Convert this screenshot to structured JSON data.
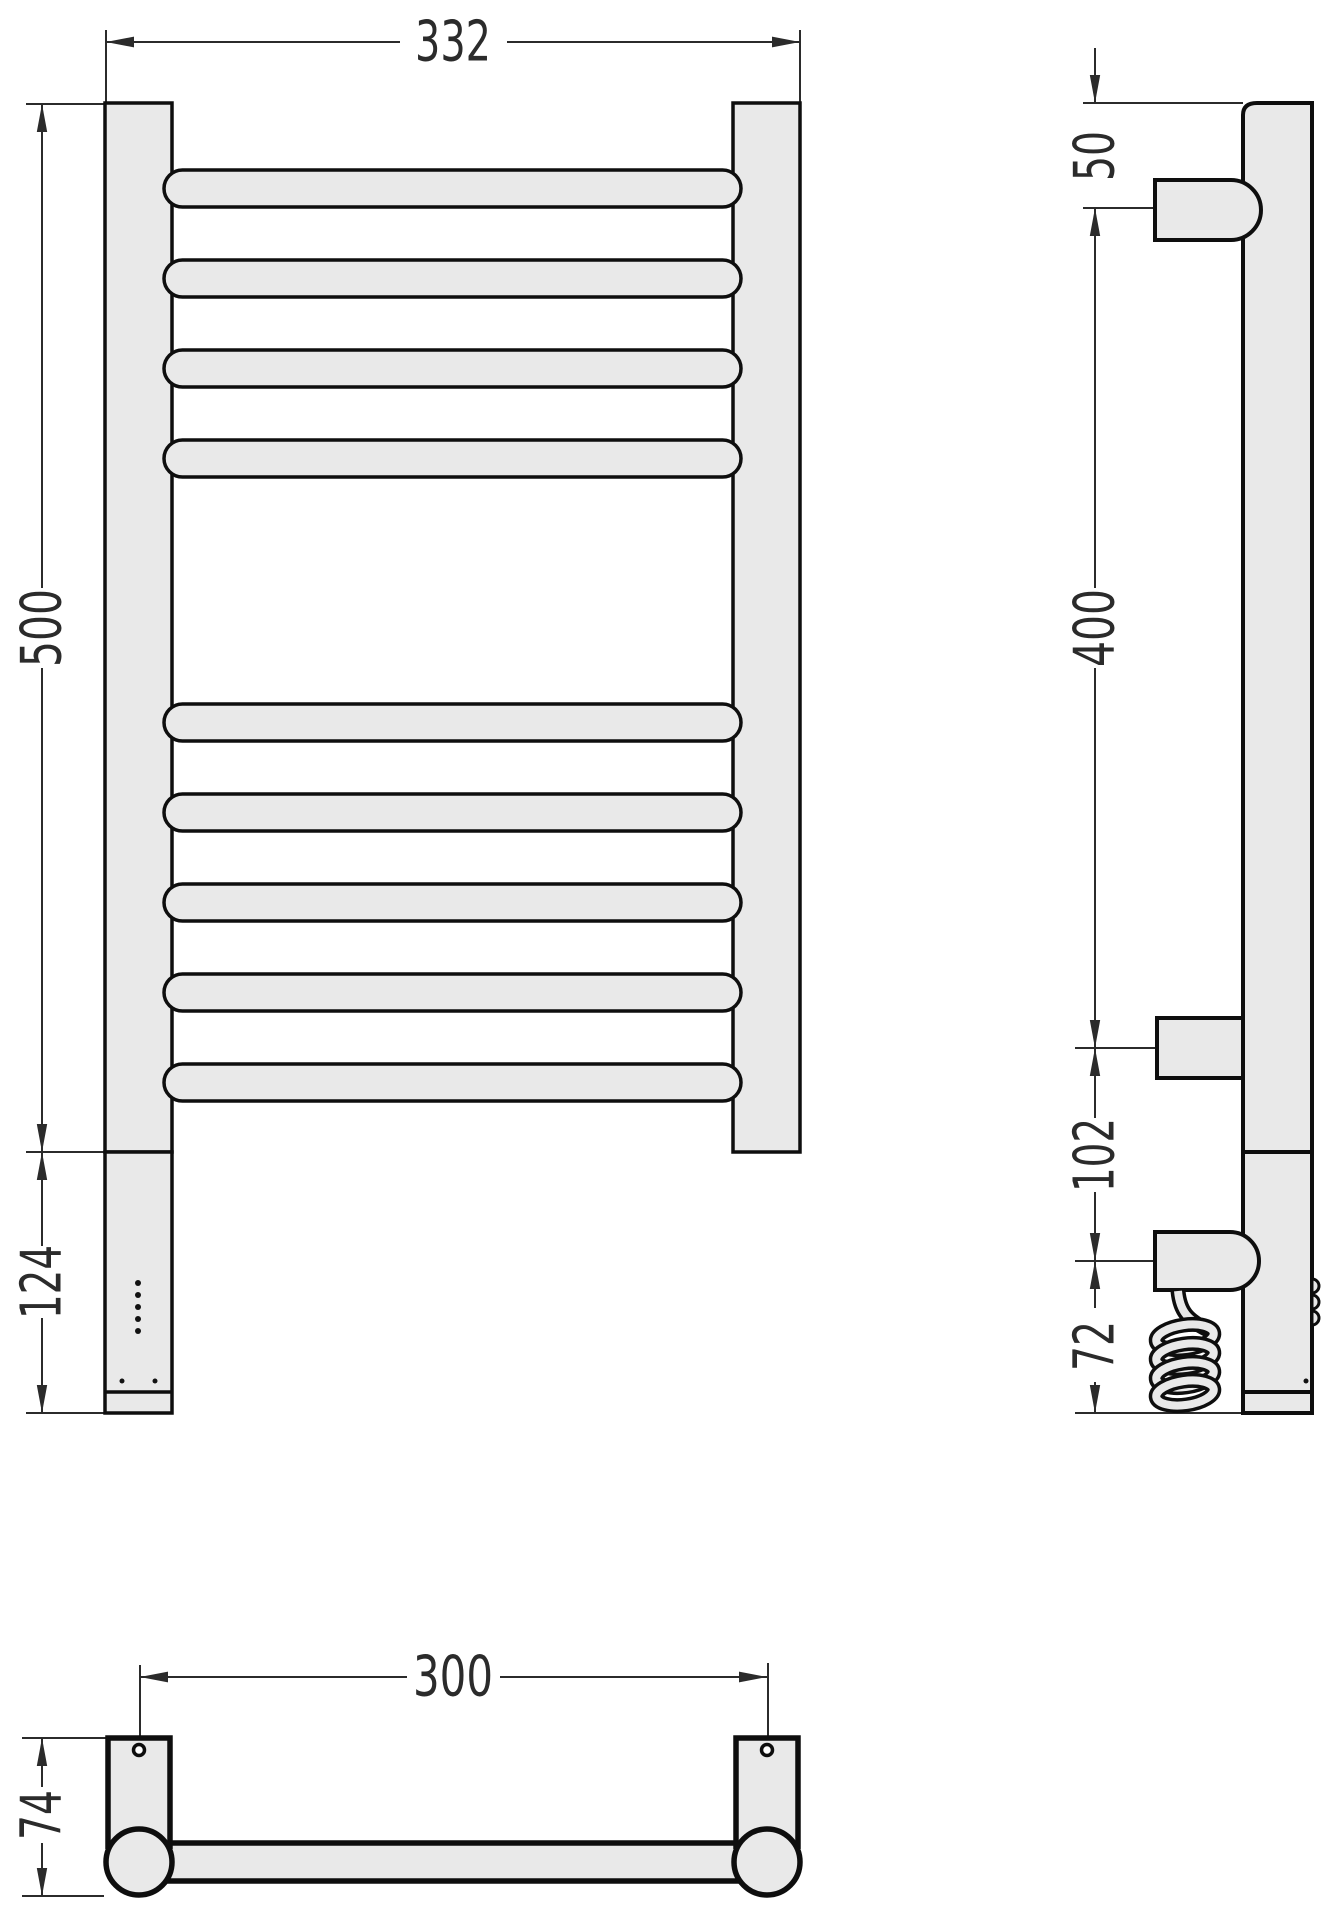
{
  "drawing": {
    "dimensions": {
      "front_width": "332",
      "front_height": "500",
      "front_lower_height": "124",
      "side_top_to_bracket": "50",
      "side_bracket_span": "400",
      "side_lower_bracket_gap": "102",
      "side_bracket_to_bottom": "72",
      "bottom_mount_spacing": "300",
      "bottom_depth": "74"
    },
    "colors": {
      "background": "#ffffff",
      "shape_fill": "#e9e9e9",
      "shape_stroke": "#0e0e0e",
      "dimension_color": "#2b2b2b"
    }
  }
}
